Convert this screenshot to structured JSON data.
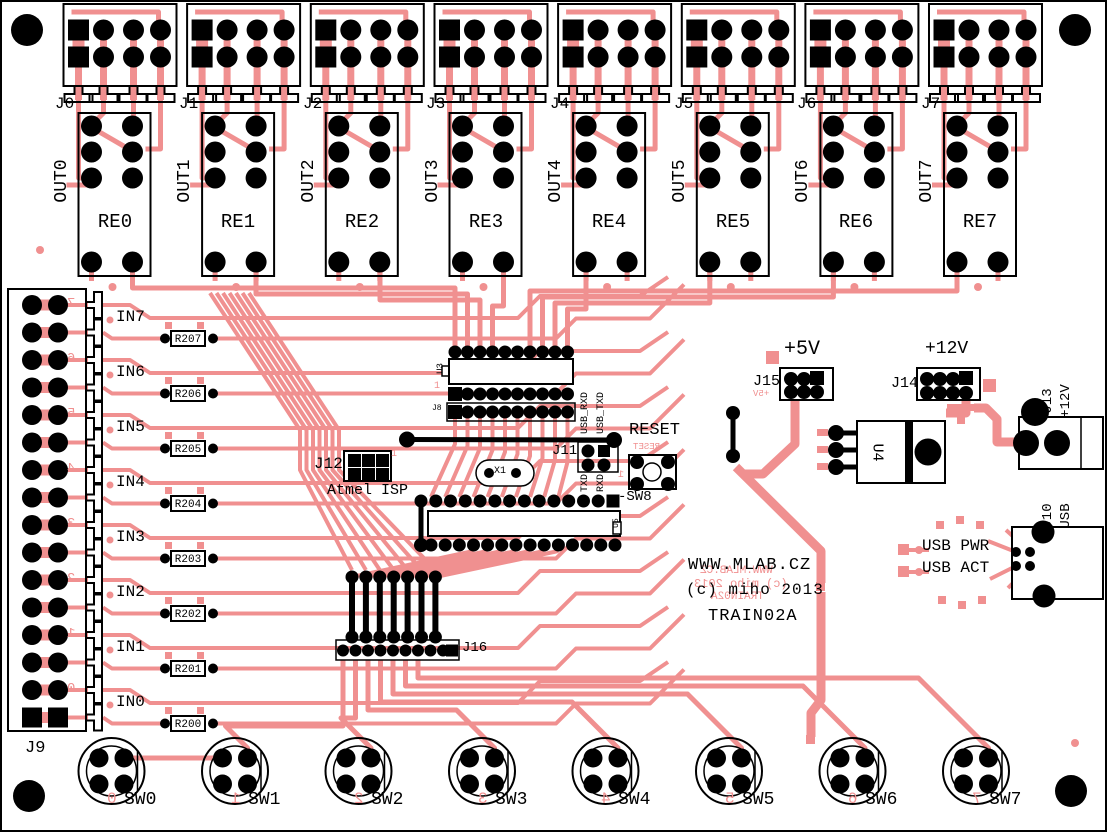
{
  "colors": {
    "copper": "#F09090",
    "silk": "#000000",
    "board": "#ffffff"
  },
  "title": {
    "lines": [
      "WWW.MLAB.CZ",
      "(c) miho 2013",
      "TRAIN02A"
    ]
  },
  "output_blocks": [
    {
      "connector": "J0",
      "out": "OUT0",
      "relay": "RE0"
    },
    {
      "connector": "J1",
      "out": "OUT1",
      "relay": "RE1"
    },
    {
      "connector": "J2",
      "out": "OUT2",
      "relay": "RE2"
    },
    {
      "connector": "J3",
      "out": "OUT3",
      "relay": "RE3"
    },
    {
      "connector": "J4",
      "out": "OUT4",
      "relay": "RE4"
    },
    {
      "connector": "J5",
      "out": "OUT5",
      "relay": "RE5"
    },
    {
      "connector": "J6",
      "out": "OUT6",
      "relay": "RE6"
    },
    {
      "connector": "J7",
      "out": "OUT7",
      "relay": "RE7"
    }
  ],
  "inputs": {
    "connector": "J9",
    "rows": [
      {
        "label": "IN7",
        "resistor": "R207",
        "digit": "7"
      },
      {
        "label": "IN6",
        "resistor": "R206",
        "digit": "6"
      },
      {
        "label": "IN5",
        "resistor": "R205",
        "digit": "5"
      },
      {
        "label": "IN4",
        "resistor": "R204",
        "digit": "4"
      },
      {
        "label": "IN3",
        "resistor": "R203",
        "digit": "3"
      },
      {
        "label": "IN2",
        "resistor": "R202",
        "digit": "2"
      },
      {
        "label": "IN1",
        "resistor": "R201",
        "digit": "1"
      },
      {
        "label": "IN0",
        "resistor": "R200",
        "digit": "0"
      }
    ]
  },
  "switches": [
    {
      "label": "SW0",
      "digit": "0"
    },
    {
      "label": "SW1",
      "digit": "1"
    },
    {
      "label": "SW2",
      "digit": "2"
    },
    {
      "label": "SW3",
      "digit": "3"
    },
    {
      "label": "SW4",
      "digit": "4"
    },
    {
      "label": "SW5",
      "digit": "5"
    },
    {
      "label": "SW6",
      "digit": "6"
    },
    {
      "label": "SW7",
      "digit": "7"
    }
  ],
  "center": {
    "u3": "U3",
    "j8": "J8",
    "u5": "U5",
    "x1": "X1",
    "j11": "J11",
    "usb_rxd": "USB_RXD",
    "usb_txd": "USB_TXD",
    "txd": "TXD",
    "rxd": "RXD",
    "j12": "J12",
    "isp": "Atmel ISP",
    "j16": "J16",
    "reset": "RESET",
    "sw8": "-SW8",
    "pin1": "1"
  },
  "power": {
    "plus5": "+5V",
    "j15": "J15",
    "plus12": "+12V",
    "j14": "J14",
    "u4": "U4",
    "j13": "J13",
    "j13_voltage": "+12V",
    "j10": "J10",
    "j10_type": "USB",
    "usb_pwr": "USB PWR",
    "usb_act": "USB ACT"
  }
}
